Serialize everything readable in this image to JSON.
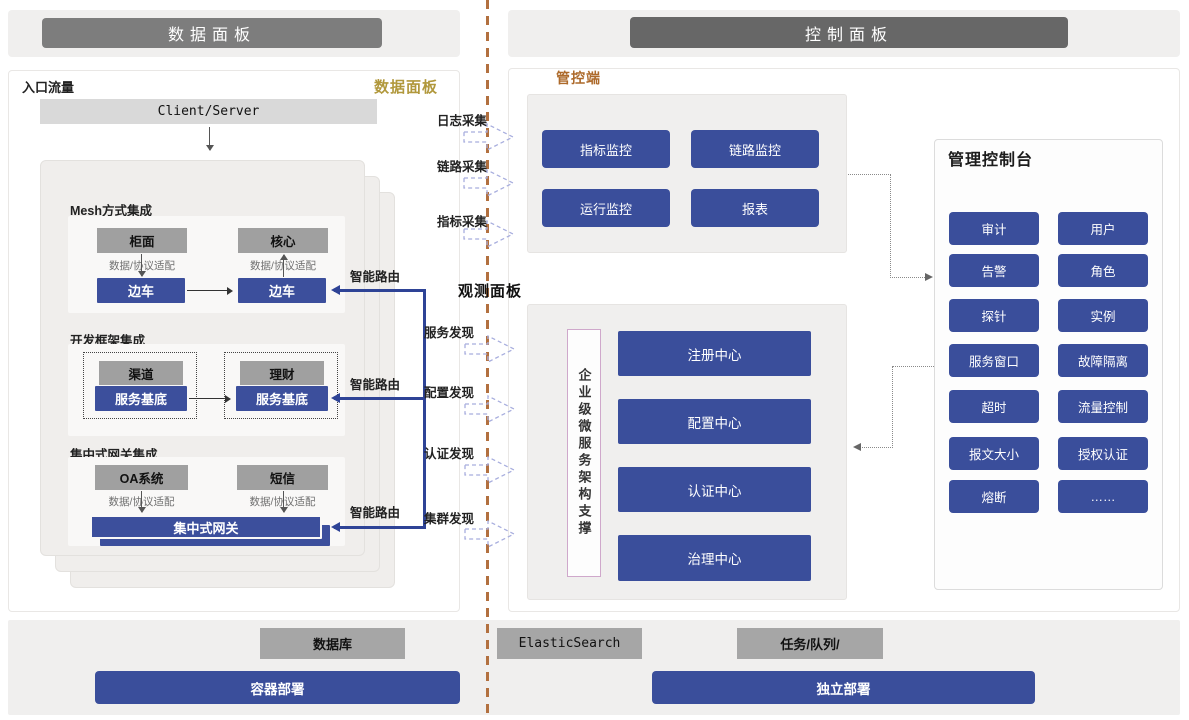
{
  "header": {
    "left": "数据面板",
    "right": "控制面板"
  },
  "data_panel": {
    "entry_label": "入口流量",
    "panel_label": "数据面板",
    "client_server": "Client/Server",
    "adapter_label": "数据/协议适配",
    "smart_routing": "智能路由",
    "mesh": {
      "title": "Mesh方式集成",
      "top_left": "柜面",
      "top_right": "核心",
      "sidecar": "边车"
    },
    "framework": {
      "title": "开发框架集成",
      "top_left": "渠道",
      "top_right": "理财",
      "base": "服务基底"
    },
    "gateway": {
      "title": "集中式网关集成",
      "top_left": "OA系统",
      "top_right": "短信",
      "bar": "集中式网关"
    }
  },
  "flows": {
    "collect": [
      "日志采集",
      "链路采集",
      "指标采集"
    ],
    "observe_title": "观测面板",
    "discover": [
      "服务发现",
      "配置发现",
      "认证发现",
      "集群发现"
    ]
  },
  "control_panel": {
    "label": "管控端",
    "monitors": [
      "指标监控",
      "链路监控",
      "运行监控",
      "报表"
    ],
    "support_vertical": "企业级微服务架构支撑",
    "centers": [
      "注册中心",
      "配置中心",
      "认证中心",
      "治理中心"
    ],
    "console": {
      "title": "管理控制台",
      "buttons": [
        "审计",
        "用户",
        "告警",
        "角色",
        "探针",
        "实例",
        "服务窗口",
        "故障隔离",
        "超时",
        "流量控制",
        "报文大小",
        "授权认证",
        "熔断",
        "……"
      ]
    }
  },
  "footer": {
    "db": "数据库",
    "es": "ElasticSearch",
    "queue": "任务/队列/",
    "container": "容器部署",
    "standalone": "独立部署"
  },
  "colors": {
    "accent_blue": "#3a4e9b",
    "divider_brown": "#b2703f",
    "gold_label": "#b1983c",
    "orange_label": "#ad6a2b"
  }
}
